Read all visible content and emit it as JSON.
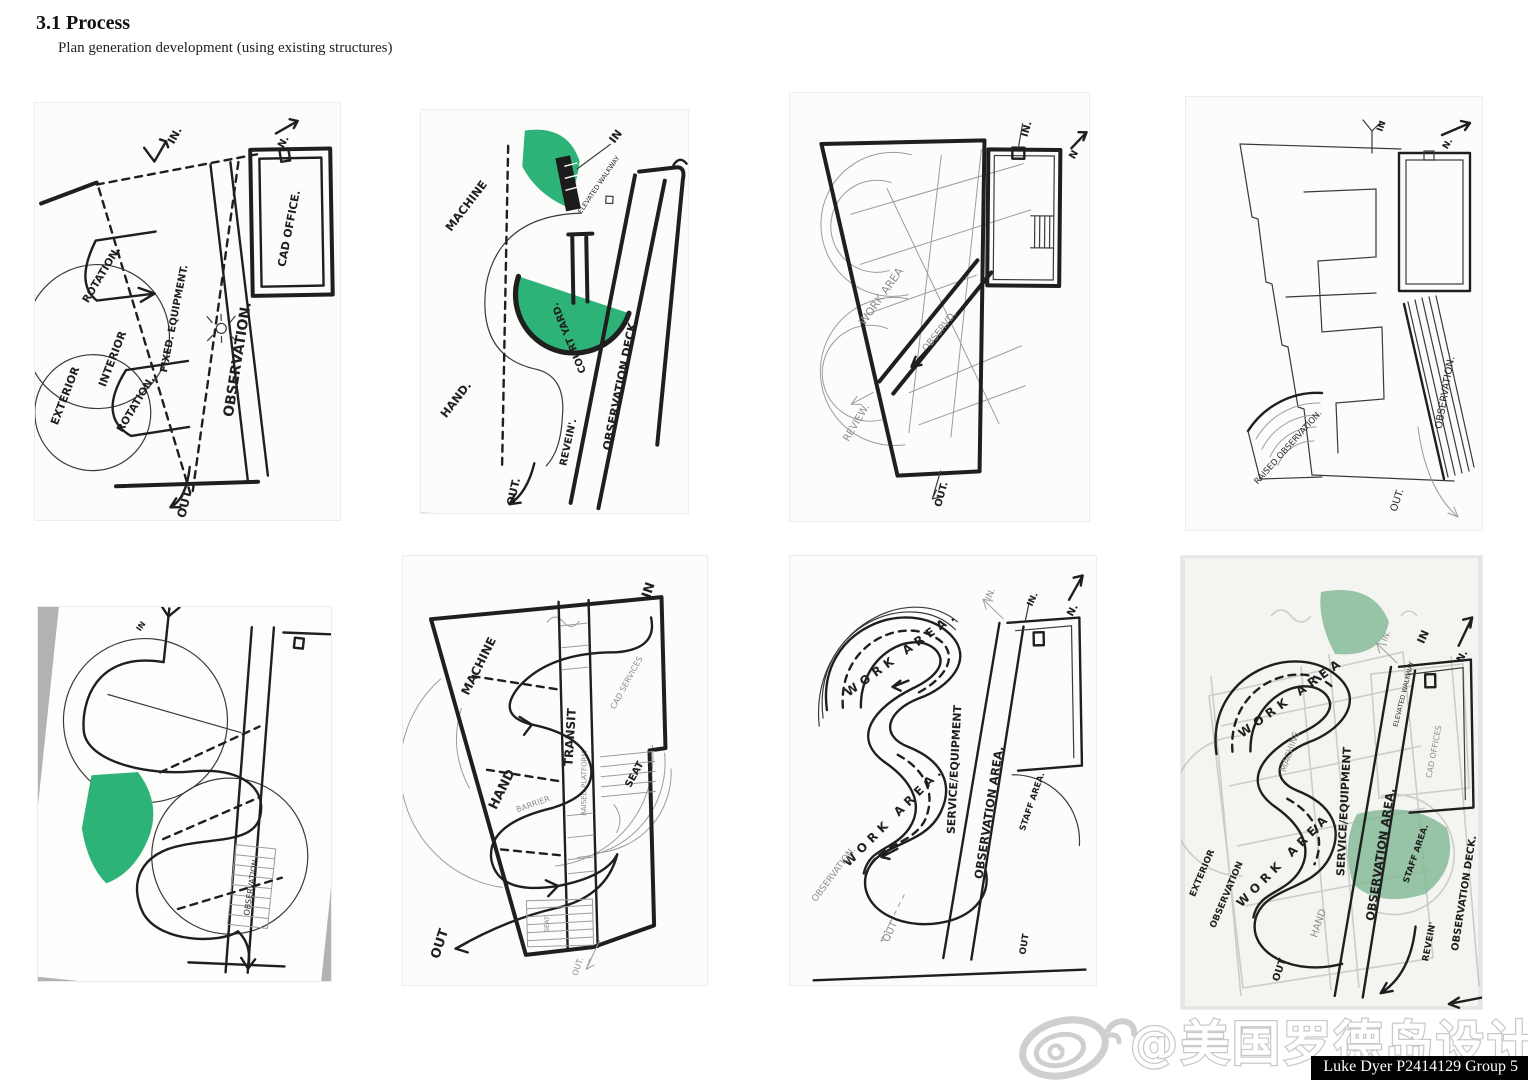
{
  "header": {
    "section_title": "3.1 Process",
    "subtitle": "Plan generation development (using existing structures)"
  },
  "colors": {
    "highlight_green": "#2db378",
    "muted_green": "#7fb694",
    "ink": "#1f1f1f",
    "pencil": "#9a9a9a",
    "scan_gray": "#b3b1b1"
  },
  "sketches": [
    {
      "labels": {
        "in": "IN.",
        "north": "N.",
        "cad_office": "CAD OFFICE.",
        "rotation_a": "ROTATION.",
        "rotation_b": "ROTATION.",
        "exterior": "EXTERIOR",
        "interior": "INTERIOR",
        "fixed_equipment": "FIXED. EQUIPMENT.",
        "observation": "OBSERVATION.",
        "out": "OUT"
      }
    },
    {
      "labels": {
        "in": "IN",
        "elevated_walkway": "ELEVATED WALKWAY",
        "machine": "MACHINE",
        "court_yard": "COURT YARD.",
        "hand": "HAND.",
        "revein": "REVEIN'.",
        "observation_deck": "OBSERVATION DECK.",
        "out": "OUT."
      }
    },
    {
      "labels": {
        "in": "IN.",
        "north": "N",
        "work_area": "WORK AREA",
        "observ": "OBSERVD.",
        "review": "REVIEW.",
        "out": "OUT."
      }
    },
    {
      "labels": {
        "in": "IN",
        "north": "N.",
        "observation": "OBSERVATION.",
        "raised_observation": "RAISED OBSERVATION.",
        "out": "OUT."
      }
    },
    {
      "labels": {
        "in": "IN",
        "observation": "OBSERVATION."
      }
    },
    {
      "labels": {
        "in": "IN",
        "machine": "MACHINE",
        "hand": "HAND",
        "transit": "TRANSIT",
        "raised_platform": "RAISED PLATFORM",
        "cad_services": "CAD SERVICES",
        "barrier": "BARRIER",
        "seat": "SEAT",
        "seat_small": "SEAT",
        "out": "OUT",
        "out_small": "OUT."
      }
    },
    {
      "labels": {
        "in_pencil": "IN.",
        "in_ink": "IN.",
        "north": "N.",
        "work_area_a": "WORK AREA.",
        "work_area_b": "WORK AREA.",
        "service_equipment": "SERVICE/EQUIPMENT",
        "observation_area": "OBSERVATION AREA.",
        "staff_area": "STAFF AREA.",
        "observation": "OBSERVATION.",
        "out_pencil": "OUT",
        "out_ink": "OUT"
      }
    },
    {
      "labels": {
        "in_pencil": "IN.",
        "in_ink": "IN",
        "north": "N.",
        "elevated_walkway": "ELEVATED WALKWAY",
        "cad_offices": "CAD OFFICES",
        "work_area_a": "WORK AREA",
        "work_area_b": "WORK AREA",
        "service_equipment": "SERVICE/EQUIPMENT",
        "observation_area": "OBSERVATION AREA.",
        "staff_area": "STAFF AREA.",
        "exterior": "EXTERIOR",
        "observation": "OBSERVATION",
        "machine": "MACHINE",
        "hand": "HAND",
        "revein": "REVEIN'",
        "observation_deck": "OBSERVATION DECK.",
        "out": "OUT"
      }
    }
  ],
  "watermark": {
    "handle": "@美国罗德岛设计学院",
    "credit": "Luke Dyer P2414129 Group 5"
  }
}
